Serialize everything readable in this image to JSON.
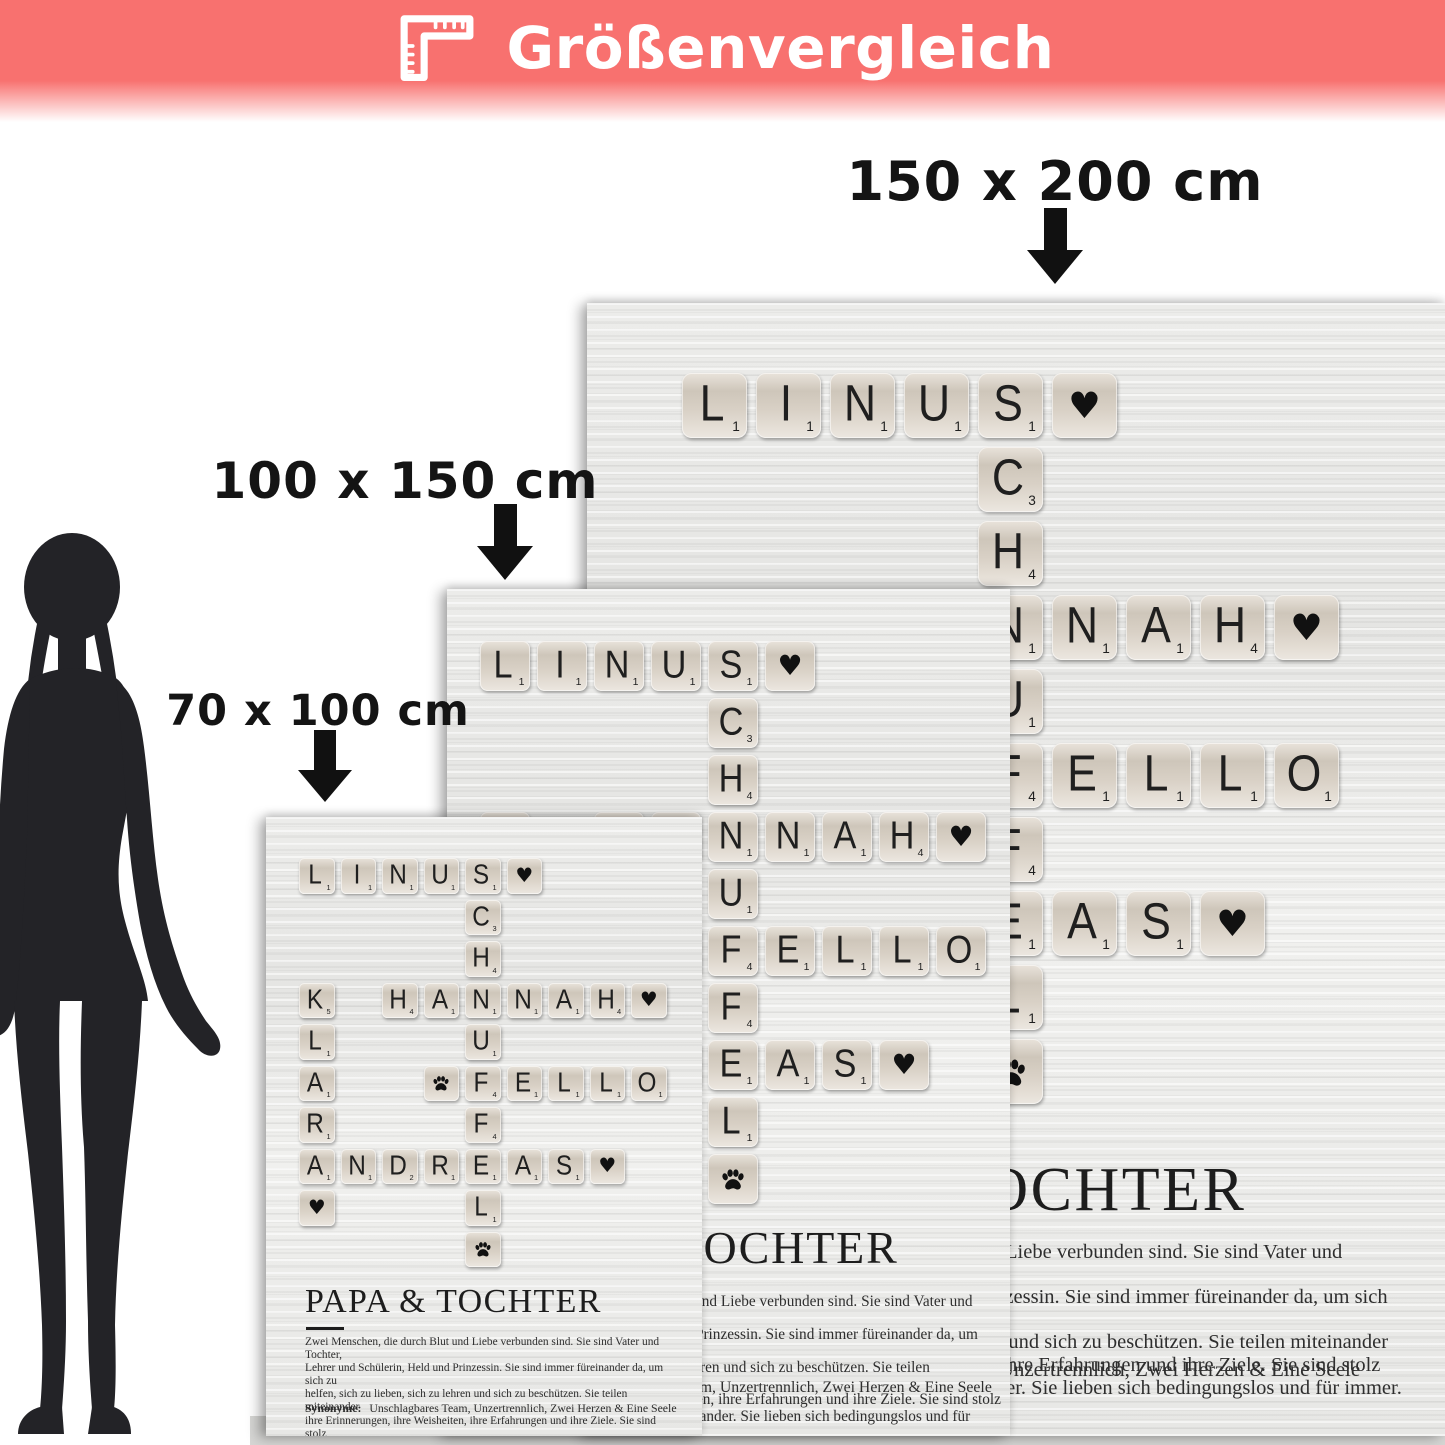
{
  "banner": {
    "title": "Größenvergleich",
    "icon": "corner-ruler-icon"
  },
  "size_labels": [
    {
      "id": "large",
      "text": "150 x 200 cm"
    },
    {
      "id": "medium",
      "text": "100 x 150 cm"
    },
    {
      "id": "small",
      "text": "70 x 100 cm"
    }
  ],
  "poster": {
    "title": "PAPA & TOCHTER",
    "description_lines": [
      "Zwei Menschen, die durch Blut und Liebe verbunden sind. Sie sind Vater und Tochter,",
      "Lehrer und Schülerin, Held und Prinzessin. Sie sind immer füreinander da, um sich zu",
      "helfen, sich zu lieben, sich zu lehren und sich zu beschützen. Sie teilen miteinander",
      "ihre Erinnerungen, ihre Weisheiten, ihre Erfahrungen und ihre Ziele. Sie sind stolz",
      "aufeinander und glücklich miteinander. Sie lieben sich bedingungslos und für immer."
    ],
    "synonyms_label": "Synonyme:",
    "synonyms_text": "Unschlagbares Team, Unzertrennlich, Zwei Herzen & Eine Seele",
    "crossword": {
      "words": [
        "LINUS",
        "SCHNUFFEL",
        "KLARA",
        "HANNAH",
        "FELLO",
        "ANDREAS"
      ],
      "tiles": [
        {
          "r": 1,
          "c": 1,
          "t": "letter",
          "g": "L",
          "v": "1"
        },
        {
          "r": 1,
          "c": 2,
          "t": "letter",
          "g": "I",
          "v": "1"
        },
        {
          "r": 1,
          "c": 3,
          "t": "letter",
          "g": "N",
          "v": "1"
        },
        {
          "r": 1,
          "c": 4,
          "t": "letter",
          "g": "U",
          "v": "1"
        },
        {
          "r": 1,
          "c": 5,
          "t": "letter",
          "g": "S",
          "v": "1"
        },
        {
          "r": 1,
          "c": 6,
          "t": "heart"
        },
        {
          "r": 2,
          "c": 5,
          "t": "letter",
          "g": "C",
          "v": "3"
        },
        {
          "r": 3,
          "c": 5,
          "t": "letter",
          "g": "H",
          "v": "4"
        },
        {
          "r": 4,
          "c": 1,
          "t": "letter",
          "g": "K",
          "v": "5"
        },
        {
          "r": 4,
          "c": 3,
          "t": "letter",
          "g": "H",
          "v": "4"
        },
        {
          "r": 4,
          "c": 4,
          "t": "letter",
          "g": "A",
          "v": "1"
        },
        {
          "r": 4,
          "c": 5,
          "t": "letter",
          "g": "N",
          "v": "1"
        },
        {
          "r": 4,
          "c": 6,
          "t": "letter",
          "g": "N",
          "v": "1"
        },
        {
          "r": 4,
          "c": 7,
          "t": "letter",
          "g": "A",
          "v": "1"
        },
        {
          "r": 4,
          "c": 8,
          "t": "letter",
          "g": "H",
          "v": "4"
        },
        {
          "r": 4,
          "c": 9,
          "t": "heart"
        },
        {
          "r": 5,
          "c": 1,
          "t": "letter",
          "g": "L",
          "v": "1"
        },
        {
          "r": 5,
          "c": 5,
          "t": "letter",
          "g": "U",
          "v": "1"
        },
        {
          "r": 6,
          "c": 1,
          "t": "letter",
          "g": "A",
          "v": "1"
        },
        {
          "r": 6,
          "c": 4,
          "t": "paw"
        },
        {
          "r": 6,
          "c": 5,
          "t": "letter",
          "g": "F",
          "v": "4"
        },
        {
          "r": 6,
          "c": 6,
          "t": "letter",
          "g": "E",
          "v": "1"
        },
        {
          "r": 6,
          "c": 7,
          "t": "letter",
          "g": "L",
          "v": "1"
        },
        {
          "r": 6,
          "c": 8,
          "t": "letter",
          "g": "L",
          "v": "1"
        },
        {
          "r": 6,
          "c": 9,
          "t": "letter",
          "g": "O",
          "v": "1"
        },
        {
          "r": 7,
          "c": 1,
          "t": "letter",
          "g": "R",
          "v": "1"
        },
        {
          "r": 7,
          "c": 5,
          "t": "letter",
          "g": "F",
          "v": "4"
        },
        {
          "r": 8,
          "c": 1,
          "t": "letter",
          "g": "A",
          "v": "1"
        },
        {
          "r": 8,
          "c": 2,
          "t": "letter",
          "g": "N",
          "v": "1"
        },
        {
          "r": 8,
          "c": 3,
          "t": "letter",
          "g": "D",
          "v": "2"
        },
        {
          "r": 8,
          "c": 4,
          "t": "letter",
          "g": "R",
          "v": "1"
        },
        {
          "r": 8,
          "c": 5,
          "t": "letter",
          "g": "E",
          "v": "1"
        },
        {
          "r": 8,
          "c": 6,
          "t": "letter",
          "g": "A",
          "v": "1"
        },
        {
          "r": 8,
          "c": 7,
          "t": "letter",
          "g": "S",
          "v": "1"
        },
        {
          "r": 8,
          "c": 8,
          "t": "heart"
        },
        {
          "r": 9,
          "c": 1,
          "t": "heart"
        },
        {
          "r": 9,
          "c": 5,
          "t": "letter",
          "g": "L",
          "v": "1"
        },
        {
          "r": 10,
          "c": 5,
          "t": "paw"
        }
      ]
    }
  },
  "silhouette": "standing-woman",
  "colors": {
    "accent": "#f8716f",
    "label_text": "#141414",
    "poster_background": "#eaeae8",
    "tile_face": "#d5ccc1",
    "floor_strip": "#d6d6d4",
    "silhouette": "#232327"
  }
}
